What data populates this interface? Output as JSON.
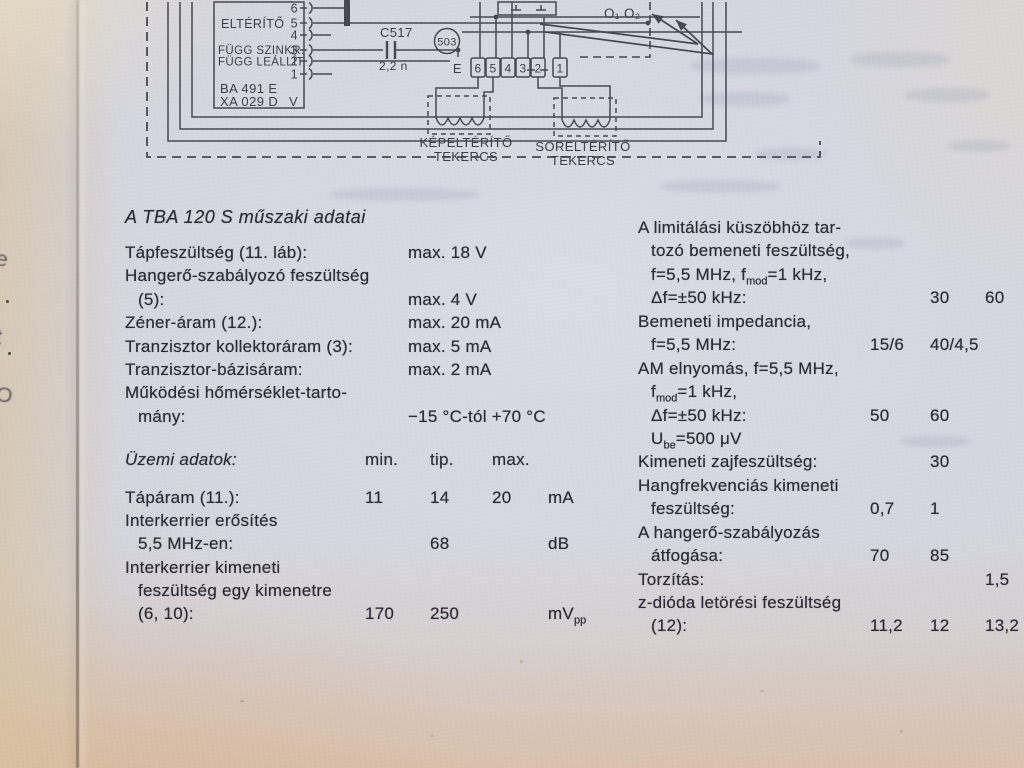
{
  "diagram": {
    "ic": {
      "label_elterito": "ELTÉRÍTŐ",
      "label_fugg_szinkr": "FÜGG SZINKR.",
      "label_fugg_leallit": "FÜGG LEÁLLÍT",
      "code_line1": "BA 491 E",
      "code_line2": "XA 029 D",
      "corner_letter": "V",
      "pins": [
        "6",
        "5",
        "4",
        "3",
        "2",
        "1"
      ]
    },
    "capacitor": {
      "name": "C517",
      "value": "2,2 n"
    },
    "ref_circle": "503",
    "strip": {
      "prefix": "E",
      "pins": [
        "6",
        "5",
        "4",
        "3",
        "2",
        "1"
      ]
    },
    "coil_left": {
      "line1": "KÉPELTÉRÍTŐ",
      "line2": "TEKERCS"
    },
    "coil_right": {
      "line1": "SORELTÉRÍTŐ",
      "line2": "TEKERCS"
    },
    "outputs": "O₁ O₂"
  },
  "left_column": {
    "heading": "A TBA 120 S műszaki adatai",
    "specs": [
      {
        "label": "Tápfeszültség (11. láb):",
        "value": "max. 18 V"
      },
      {
        "label": "Hangerő-szabályozó feszültség"
      },
      {
        "label": "(5):",
        "value": "max. 4 V"
      },
      {
        "label": "Zéner-áram (12.):",
        "value": "max. 20 mA"
      },
      {
        "label": "Tranzisztor kollektoráram (3):",
        "value": "max. 5 mA"
      },
      {
        "label": "Tranzisztor-bázisáram:",
        "value": "max. 2 mA"
      },
      {
        "label": "Működési hőmérséklet-tarto-"
      },
      {
        "label": "mány:",
        "value": "−15 °C-tól  +70 °C"
      }
    ],
    "table": {
      "header": {
        "label": "Üzemi adatok:",
        "c1": "min.",
        "c2": "tip.",
        "c3": "max."
      },
      "rows": [
        {
          "label": "Tápáram (11.):",
          "c1": "11",
          "c2": "14",
          "c3": "20",
          "u": "mA"
        },
        {
          "label": "Interkerrier erősítés"
        },
        {
          "label": "5,5 MHz-en:",
          "c2": "68",
          "u": "dB"
        },
        {
          "label": "Interkerrier kimeneti"
        },
        {
          "label": "feszültség egy kimenetre"
        },
        {
          "label": "(6, 10):",
          "c1": "170",
          "c2": "250",
          "u": "mV",
          "usub": "pp"
        }
      ]
    }
  },
  "right_column": {
    "rows": [
      {
        "t1": "A limitálási küszöbhöz tar-"
      },
      {
        "t1": "tozó bemeneti feszültség,"
      },
      {
        "t1": "f=5,5 MHz, f",
        "s1": "mod",
        "t2": "=1 kHz,"
      },
      {
        "t1": "Δf=±50 kHz:",
        "v2": "30",
        "v3": "60"
      },
      {
        "t1": "Bemeneti impedancia,"
      },
      {
        "t1": "f=5,5 MHz:",
        "v1": "15/6",
        "v2": "40/4,5"
      },
      {
        "t1": "AM elnyomás, f=5,5 MHz,"
      },
      {
        "t1": "f",
        "s1": "mod",
        "t2": "=1 kHz,"
      },
      {
        "t1": "Δf=±50 kHz:",
        "v1": "50",
        "v2": "60"
      },
      {
        "t1": "U",
        "s1": "be",
        "t2": "=500 μV"
      },
      {
        "t1": "Kimeneti zajfeszültség:",
        "v2": "30"
      },
      {
        "t1": "Hangfrekvenciás kimeneti"
      },
      {
        "t1": "feszültség:",
        "v1": "0,7",
        "v2": "1"
      },
      {
        "t1": "A hangerő-szabályozás"
      },
      {
        "t1": "átfogása:",
        "v1": "70",
        "v2": "85"
      },
      {
        "t1": "Torzítás:",
        "v3": "1,5"
      },
      {
        "t1": "z-dióda letörési feszültség"
      },
      {
        "t1": "(12):",
        "v1": "11,2",
        "v2": "12",
        "v3": "13,2"
      }
    ]
  },
  "edge_fragments": [
    "e",
    "t",
    "O"
  ]
}
